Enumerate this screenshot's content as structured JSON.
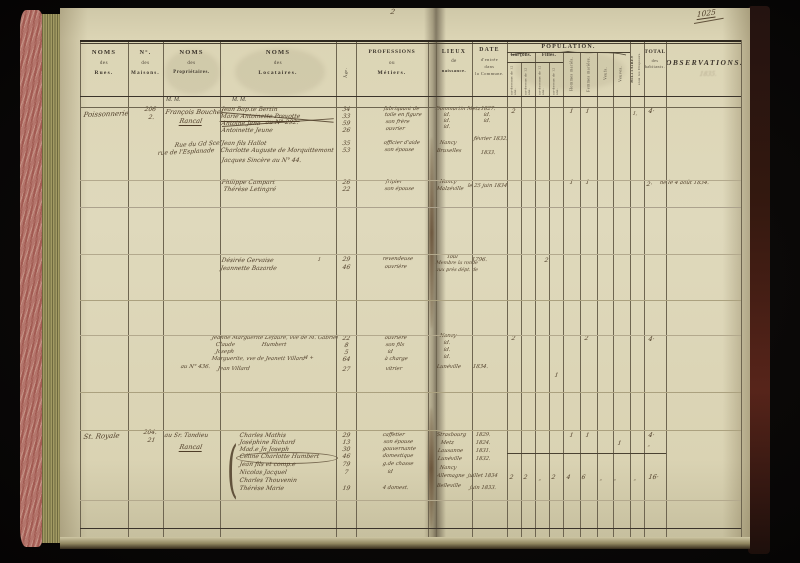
{
  "marks": {
    "folio": "1025",
    "page_number": "2"
  },
  "header": {
    "rues": [
      "NOMS",
      "des",
      "Rues."
    ],
    "maisons": [
      "N°.",
      "des",
      "Maisons."
    ],
    "proprietaires": [
      "NOMS",
      "des",
      "Propriétaires."
    ],
    "locataires": [
      "NOMS",
      "des",
      "Locataires."
    ],
    "age": "Âge.",
    "professions": [
      "PROFESSIONS",
      "ou",
      "Métiers."
    ],
    "lieux": [
      "LIEUX",
      "de",
      "naissance."
    ],
    "date": [
      "DATE",
      "d'entrée",
      "dans",
      "la Commune."
    ],
    "population": {
      "title": "POPULATION.",
      "garcons": "Garçons.",
      "filles": "Filles.",
      "sub_low": "au-dessous de 12 ans.",
      "sub_high": "au-dessus de 12 ans.",
      "hommes": "Hommes mariés.",
      "femmes": "Femmes mariées.",
      "veufs": "Veufs.",
      "veuves": "Veuves."
    },
    "militaires": [
      "MILITAIRES",
      "sous les Drapeaux."
    ],
    "total": [
      "TOTAL",
      "des",
      "habitants."
    ],
    "observations": "OBSERVATIONS.",
    "mm": "M. M."
  },
  "entries": [
    {
      "t": "Poissonnerie",
      "x": 84,
      "y": 112,
      "s": 7,
      "r": -2
    },
    {
      "t": "206",
      "x": 145,
      "y": 107,
      "s": 6
    },
    {
      "t": "2.",
      "x": 149,
      "y": 115,
      "s": 6
    },
    {
      "t": "François Bouchel",
      "x": 166,
      "y": 109,
      "s": 6.5
    },
    {
      "t": "Rancal",
      "x": 180,
      "y": 118,
      "s": 6.5,
      "u": true
    },
    {
      "t": "Jean Bap.te Bertin",
      "x": 222,
      "y": 107,
      "s": 6
    },
    {
      "t": "Marie Antoinette Prevotte",
      "x": 221,
      "y": 114,
      "s": 6,
      "u": true
    },
    {
      "t": "Antoine Jena",
      "x": 222,
      "y": 121,
      "s": 6
    },
    {
      "t": "au N° 292.",
      "x": 266,
      "y": 120,
      "s": 6
    },
    {
      "t": "Antoinette Jeune",
      "x": 222,
      "y": 128,
      "s": 6
    },
    {
      "t": "34",
      "x": 343,
      "y": 107,
      "s": 6
    },
    {
      "t": "33",
      "x": 343,
      "y": 114,
      "s": 6
    },
    {
      "t": "59",
      "x": 343,
      "y": 121,
      "s": 6
    },
    {
      "t": "26",
      "x": 343,
      "y": 128,
      "s": 6
    },
    {
      "t": "fabriquant de",
      "x": 384,
      "y": 107,
      "s": 5.2
    },
    {
      "t": "toile en figure",
      "x": 385,
      "y": 113,
      "s": 5.2
    },
    {
      "t": "son frère",
      "x": 386,
      "y": 120,
      "s": 5.2
    },
    {
      "t": "ouvrier",
      "x": 386,
      "y": 127,
      "s": 5.2
    },
    {
      "t": "Rue du Gd Scel",
      "x": 175,
      "y": 143,
      "s": 6,
      "r": -3
    },
    {
      "t": "rue de l'Esplanade",
      "x": 158,
      "y": 151,
      "s": 6,
      "r": -3
    },
    {
      "t": "Jean fils Hallot",
      "x": 222,
      "y": 141,
      "s": 6
    },
    {
      "t": "Charlotte Auguste de Morquittemont",
      "x": 221,
      "y": 148,
      "s": 6
    },
    {
      "t": "Jacques Sincère au N° 44.",
      "x": 222,
      "y": 158,
      "s": 6
    },
    {
      "t": "35",
      "x": 343,
      "y": 141,
      "s": 6
    },
    {
      "t": "53",
      "x": 343,
      "y": 148,
      "s": 6
    },
    {
      "t": "officier d'aide",
      "x": 384,
      "y": 141,
      "s": 5.2
    },
    {
      "t": "son épouse",
      "x": 385,
      "y": 148,
      "s": 5.2
    },
    {
      "t": "Dommartin Metz",
      "x": 436,
      "y": 107,
      "s": 5.2
    },
    {
      "t": "id.",
      "x": 444,
      "y": 113,
      "s": 5.2
    },
    {
      "t": "id.",
      "x": 444,
      "y": 119,
      "s": 5.2
    },
    {
      "t": "id.",
      "x": 444,
      "y": 125,
      "s": 5.2
    },
    {
      "t": "Nancy",
      "x": 440,
      "y": 141,
      "s": 5.2
    },
    {
      "t": "Bruxelles",
      "x": 437,
      "y": 149,
      "s": 5.2
    },
    {
      "t": "1827.",
      "x": 481,
      "y": 107,
      "s": 5.2
    },
    {
      "t": "id.",
      "x": 484,
      "y": 113,
      "s": 5.2
    },
    {
      "t": "id.",
      "x": 484,
      "y": 119,
      "s": 5.2
    },
    {
      "t": "février 1832.",
      "x": 474,
      "y": 137,
      "s": 5.2
    },
    {
      "t": "1833.",
      "x": 481,
      "y": 151,
      "s": 5.2
    },
    {
      "t": "2",
      "x": 512,
      "y": 109,
      "s": 6
    },
    {
      "t": "1",
      "x": 570,
      "y": 109,
      "s": 6
    },
    {
      "t": "1",
      "x": 586,
      "y": 109,
      "s": 6
    },
    {
      "t": "1,",
      "x": 633,
      "y": 112,
      "s": 5
    },
    {
      "t": "4·",
      "x": 649,
      "y": 108,
      "s": 6.5
    },
    {
      "t": "Philippe Campart",
      "x": 222,
      "y": 180,
      "s": 6
    },
    {
      "t": "Thérèse Letingré",
      "x": 224,
      "y": 187,
      "s": 6
    },
    {
      "t": "26",
      "x": 343,
      "y": 180,
      "s": 6
    },
    {
      "t": "22",
      "x": 343,
      "y": 187,
      "s": 6
    },
    {
      "t": "fripier",
      "x": 386,
      "y": 180,
      "s": 5.2
    },
    {
      "t": "son épouse",
      "x": 385,
      "y": 187,
      "s": 5.2
    },
    {
      "t": "Nancy",
      "x": 440,
      "y": 180,
      "s": 5.2
    },
    {
      "t": "Malzéville",
      "x": 437,
      "y": 187,
      "s": 5.2
    },
    {
      "t": "le 25 juin 1834.",
      "x": 468,
      "y": 184,
      "s": 5.2
    },
    {
      "t": "1",
      "x": 570,
      "y": 180,
      "s": 6
    },
    {
      "t": "1",
      "x": 586,
      "y": 180,
      "s": 6
    },
    {
      "t": "2·",
      "x": 647,
      "y": 182,
      "s": 6
    },
    {
      "t": "né le 4 août 1834.",
      "x": 660,
      "y": 181,
      "s": 5.4
    },
    {
      "t": "Désirée Gervaise",
      "x": 222,
      "y": 258,
      "s": 6
    },
    {
      "t": "Jeannette Bazarde",
      "x": 221,
      "y": 266,
      "s": 6
    },
    {
      "t": "1",
      "x": 318,
      "y": 258,
      "s": 5
    },
    {
      "t": "29",
      "x": 343,
      "y": 257,
      "s": 6
    },
    {
      "t": "46",
      "x": 343,
      "y": 265,
      "s": 6
    },
    {
      "t": "revendeuse",
      "x": 383,
      "y": 257,
      "s": 5.2
    },
    {
      "t": "ouvrière",
      "x": 385,
      "y": 265,
      "s": 5.2
    },
    {
      "t": "Toul",
      "x": 447,
      "y": 255,
      "s": 5.2
    },
    {
      "t": "Membre la ronde",
      "x": 436,
      "y": 262,
      "s": 4.8
    },
    {
      "t": "aux près dépt. de",
      "x": 436,
      "y": 269,
      "s": 4.8
    },
    {
      "t": "1796.",
      "x": 472,
      "y": 258,
      "s": 5.4
    },
    {
      "t": "2",
      "x": 545,
      "y": 258,
      "s": 6
    },
    {
      "t": "Jeanne Marguerite Lefaure, vve de M. Gabriel",
      "x": 212,
      "y": 336,
      "s": 5.4
    },
    {
      "t": "Claude",
      "x": 216,
      "y": 343,
      "s": 5.4
    },
    {
      "t": "Humbert",
      "x": 262,
      "y": 343,
      "s": 5.4
    },
    {
      "t": "Joseph",
      "x": 216,
      "y": 350,
      "s": 5.4
    },
    {
      "t": "Marguerite, vve de Jeanett Villard",
      "x": 212,
      "y": 357,
      "s": 5.4
    },
    {
      "t": "4 +",
      "x": 305,
      "y": 356,
      "s": 5
    },
    {
      "t": "Jean Villard",
      "x": 218,
      "y": 367,
      "s": 5.4
    },
    {
      "t": "au N° 436.",
      "x": 181,
      "y": 365,
      "s": 5.4
    },
    {
      "t": "22",
      "x": 343,
      "y": 336,
      "s": 6
    },
    {
      "t": "8",
      "x": 345,
      "y": 343,
      "s": 6
    },
    {
      "t": "5",
      "x": 345,
      "y": 350,
      "s": 6
    },
    {
      "t": "64",
      "x": 343,
      "y": 357,
      "s": 6
    },
    {
      "t": "27",
      "x": 343,
      "y": 367,
      "s": 6
    },
    {
      "t": "ouvrière",
      "x": 385,
      "y": 336,
      "s": 5.2
    },
    {
      "t": "son fils",
      "x": 386,
      "y": 343,
      "s": 5.2
    },
    {
      "t": "id",
      "x": 388,
      "y": 350,
      "s": 5.2
    },
    {
      "t": "à charge",
      "x": 385,
      "y": 357,
      "s": 5.2
    },
    {
      "t": "vitrier",
      "x": 386,
      "y": 367,
      "s": 5.2
    },
    {
      "t": "Nancy",
      "x": 440,
      "y": 334,
      "s": 5.2
    },
    {
      "t": "id.",
      "x": 444,
      "y": 341,
      "s": 5.2
    },
    {
      "t": "id.",
      "x": 444,
      "y": 348,
      "s": 5.2
    },
    {
      "t": "id.",
      "x": 444,
      "y": 355,
      "s": 5.2
    },
    {
      "t": "Lunéville",
      "x": 437,
      "y": 365,
      "s": 5.2
    },
    {
      "t": "1834.",
      "x": 473,
      "y": 365,
      "s": 5.4
    },
    {
      "t": "2",
      "x": 512,
      "y": 336,
      "s": 6
    },
    {
      "t": "2",
      "x": 585,
      "y": 336,
      "s": 6
    },
    {
      "t": "4·",
      "x": 649,
      "y": 336,
      "s": 6.5
    },
    {
      "t": "1",
      "x": 555,
      "y": 373,
      "s": 6
    },
    {
      "t": "St. Royale",
      "x": 84,
      "y": 434,
      "s": 7,
      "r": -2
    },
    {
      "t": "204.",
      "x": 144,
      "y": 430,
      "s": 6
    },
    {
      "t": "21",
      "x": 148,
      "y": 438,
      "s": 6
    },
    {
      "t": "au Sr. Tandieu",
      "x": 165,
      "y": 433,
      "s": 6
    },
    {
      "t": "Rancal",
      "x": 180,
      "y": 444,
      "s": 6.5,
      "u": true
    },
    {
      "t": "Charles Mathis",
      "x": 240,
      "y": 433,
      "s": 6
    },
    {
      "t": "Joséphine Richard",
      "x": 240,
      "y": 440,
      "s": 6
    },
    {
      "t": "Mad.e Jn Joseph",
      "x": 240,
      "y": 447,
      "s": 6
    },
    {
      "t": "Céline Charlotte Humbert",
      "x": 240,
      "y": 454,
      "s": 6
    },
    {
      "t": "Jean fils et comp.e",
      "x": 240,
      "y": 462,
      "s": 6
    },
    {
      "t": "Nicolas Jacquel",
      "x": 240,
      "y": 470,
      "s": 6
    },
    {
      "t": "Charles Thouvenin",
      "x": 240,
      "y": 478,
      "s": 6
    },
    {
      "t": "Thérèse Marie",
      "x": 240,
      "y": 486,
      "s": 6
    },
    {
      "t": "29",
      "x": 343,
      "y": 433,
      "s": 6
    },
    {
      "t": "13",
      "x": 343,
      "y": 440,
      "s": 6
    },
    {
      "t": "30",
      "x": 343,
      "y": 447,
      "s": 6
    },
    {
      "t": "46",
      "x": 343,
      "y": 454,
      "s": 6
    },
    {
      "t": "79",
      "x": 343,
      "y": 462,
      "s": 6
    },
    {
      "t": "7",
      "x": 345,
      "y": 470,
      "s": 6
    },
    {
      "t": "19",
      "x": 343,
      "y": 486,
      "s": 6
    },
    {
      "t": "caffetier",
      "x": 383,
      "y": 433,
      "s": 5.2
    },
    {
      "t": "son épouse",
      "x": 384,
      "y": 440,
      "s": 5.2
    },
    {
      "t": "gouvernante",
      "x": 383,
      "y": 447,
      "s": 5.2
    },
    {
      "t": "domestique",
      "x": 383,
      "y": 454,
      "s": 5.2
    },
    {
      "t": "g.de chasse",
      "x": 383,
      "y": 462,
      "s": 5.2
    },
    {
      "t": "id",
      "x": 388,
      "y": 470,
      "s": 5.2
    },
    {
      "t": "4 domest.",
      "x": 383,
      "y": 486,
      "s": 5.2
    },
    {
      "t": "Strasbourg",
      "x": 437,
      "y": 433,
      "s": 5.2
    },
    {
      "t": "Metz",
      "x": 441,
      "y": 441,
      "s": 5.2
    },
    {
      "t": "Lausanne",
      "x": 438,
      "y": 449,
      "s": 5.2
    },
    {
      "t": "Lunéville",
      "x": 438,
      "y": 457,
      "s": 5.2
    },
    {
      "t": "Nancy",
      "x": 440,
      "y": 466,
      "s": 5.2
    },
    {
      "t": "Allemagne",
      "x": 437,
      "y": 474,
      "s": 5.2
    },
    {
      "t": "Belleville",
      "x": 437,
      "y": 484,
      "s": 5.2
    },
    {
      "t": "1829.",
      "x": 476,
      "y": 433,
      "s": 5.2
    },
    {
      "t": "1824.",
      "x": 476,
      "y": 441,
      "s": 5.2
    },
    {
      "t": "1831.",
      "x": 476,
      "y": 449,
      "s": 5.2
    },
    {
      "t": "1832.",
      "x": 476,
      "y": 457,
      "s": 5.2
    },
    {
      "t": "juillet 1834",
      "x": 468,
      "y": 474,
      "s": 5.2
    },
    {
      "t": "juin 1833.",
      "x": 470,
      "y": 486,
      "s": 5.2
    },
    {
      "t": "1",
      "x": 570,
      "y": 433,
      "s": 6
    },
    {
      "t": "1",
      "x": 586,
      "y": 433,
      "s": 6
    },
    {
      "t": "4·",
      "x": 649,
      "y": 432,
      "s": 6.5
    },
    {
      "t": "1",
      "x": 618,
      "y": 441,
      "s": 6
    },
    {
      "t": "„",
      "x": 648,
      "y": 443,
      "s": 5
    },
    {
      "t": "2",
      "x": 510,
      "y": 475,
      "s": 6
    },
    {
      "t": "2",
      "x": 524,
      "y": 475,
      "s": 6
    },
    {
      "t": "„",
      "x": 539,
      "y": 477,
      "s": 5
    },
    {
      "t": "2",
      "x": 552,
      "y": 475,
      "s": 6
    },
    {
      "t": "4",
      "x": 567,
      "y": 475,
      "s": 6
    },
    {
      "t": "6",
      "x": 582,
      "y": 475,
      "s": 6
    },
    {
      "t": "„",
      "x": 600,
      "y": 477,
      "s": 5
    },
    {
      "t": "„",
      "x": 614,
      "y": 477,
      "s": 5
    },
    {
      "t": "„",
      "x": 634,
      "y": 477,
      "s": 5
    },
    {
      "t": "16·",
      "x": 649,
      "y": 474,
      "s": 6.5
    },
    {
      "t": "1835.",
      "x": 700,
      "y": 72,
      "s": 6,
      "g": true
    }
  ]
}
